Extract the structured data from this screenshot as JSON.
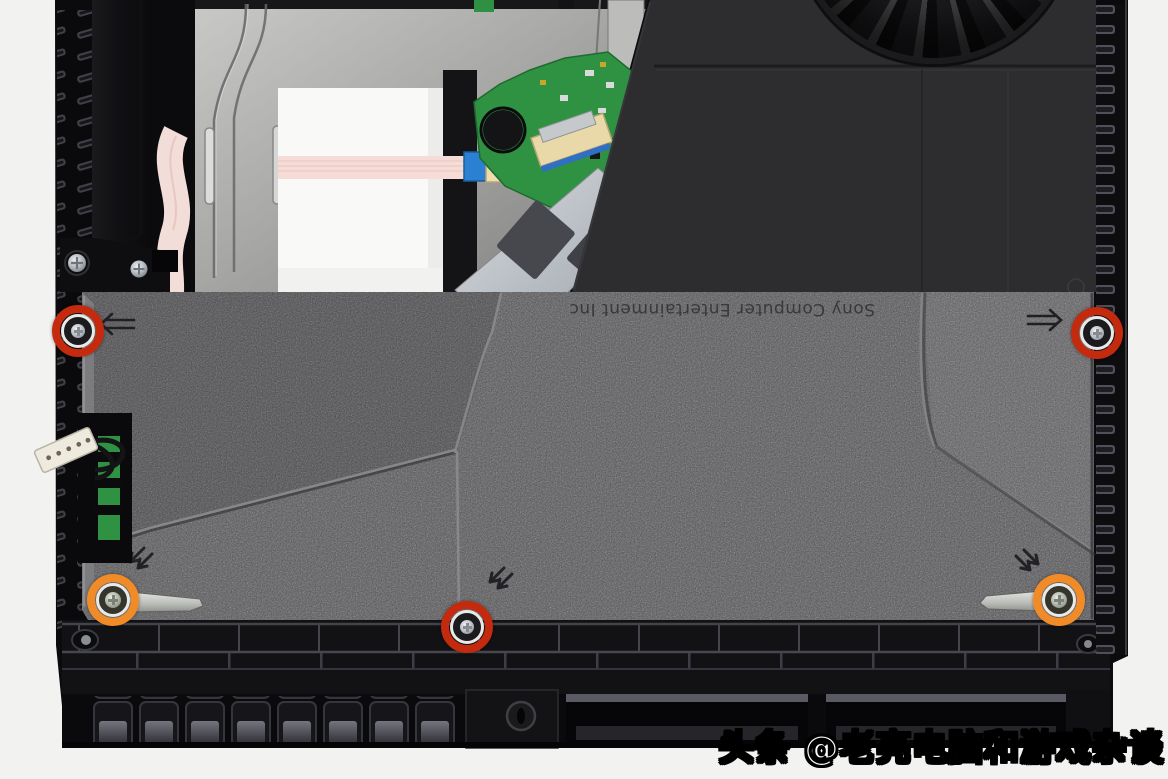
{
  "photo": {
    "description": "PlayStation 4 teardown photo, top-down view of internals with power supply cover",
    "embossed_text": "Sony Computer Entertainment Inc",
    "watermark": "头条 @老亮电脑和游戏杂谈"
  },
  "annotations": {
    "red_color": "#c32a0e",
    "orange_color": "#f08b28",
    "screws": [
      {
        "id": "red-top-left",
        "color": "red",
        "x": 78,
        "y": 331
      },
      {
        "id": "red-top-right",
        "color": "red",
        "x": 1097,
        "y": 333
      },
      {
        "id": "red-bottom-center",
        "color": "red",
        "x": 467,
        "y": 627
      },
      {
        "id": "orange-bottom-left",
        "color": "orange",
        "x": 113,
        "y": 600
      },
      {
        "id": "orange-bottom-right",
        "color": "orange",
        "x": 1059,
        "y": 600
      }
    ]
  }
}
